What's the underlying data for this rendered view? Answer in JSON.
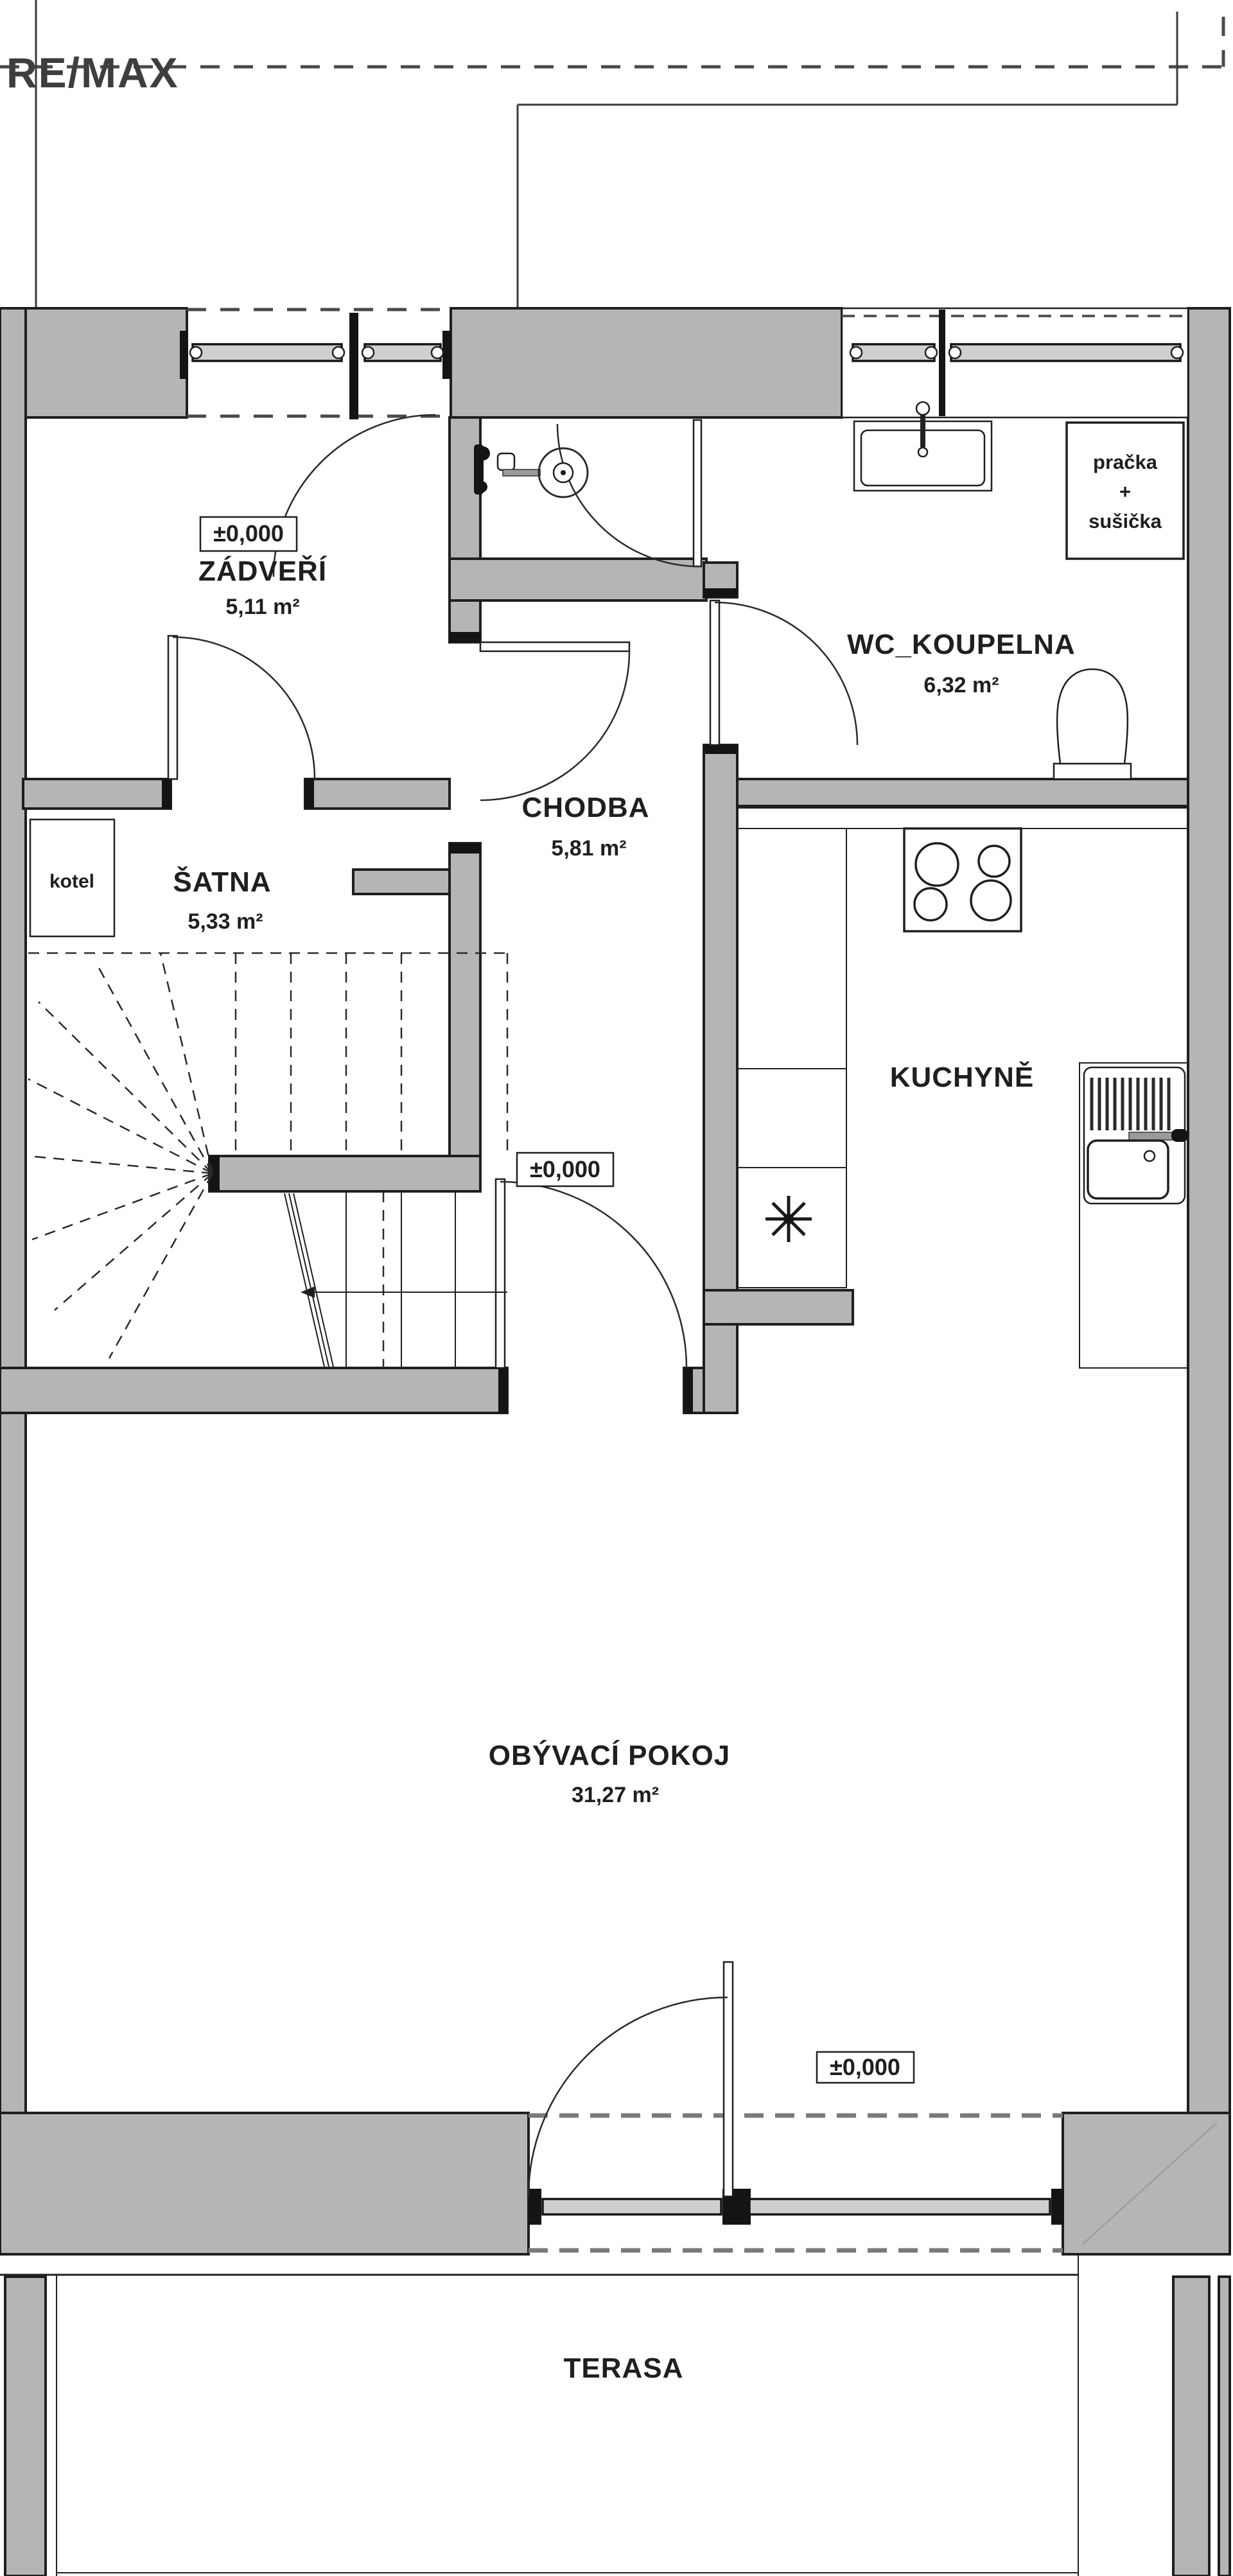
{
  "branding": {
    "logo_text": "RE/MAX",
    "logo_color": "#3e3e3e"
  },
  "floor_plan": {
    "rooms": [
      {
        "name": "ZÁDVEŘÍ",
        "area": "5,11 m²",
        "level_marker": "±0,000"
      },
      {
        "name": "WC_KOUPELNA",
        "area": "6,32 m²"
      },
      {
        "name": "CHODBA",
        "area": "5,81 m²",
        "level_marker": "±0,000"
      },
      {
        "name": "ŠATNA",
        "area": "5,33 m²"
      },
      {
        "name": "KUCHYNĚ"
      },
      {
        "name": "OBÝVACÍ POKOJ",
        "area": "31,27 m²",
        "level_marker": "±0,000"
      },
      {
        "name": "TERASA"
      }
    ],
    "equipment_labels": {
      "boiler": "kotel",
      "washer_line1": "pračka",
      "washer_line2": "+",
      "washer_line3": "sušička"
    },
    "colors": {
      "wall_fill": "#b5b5b5",
      "outline": "#1f1f1f",
      "dashed_line": "#4a4a4a",
      "background": "#ffffff"
    }
  }
}
